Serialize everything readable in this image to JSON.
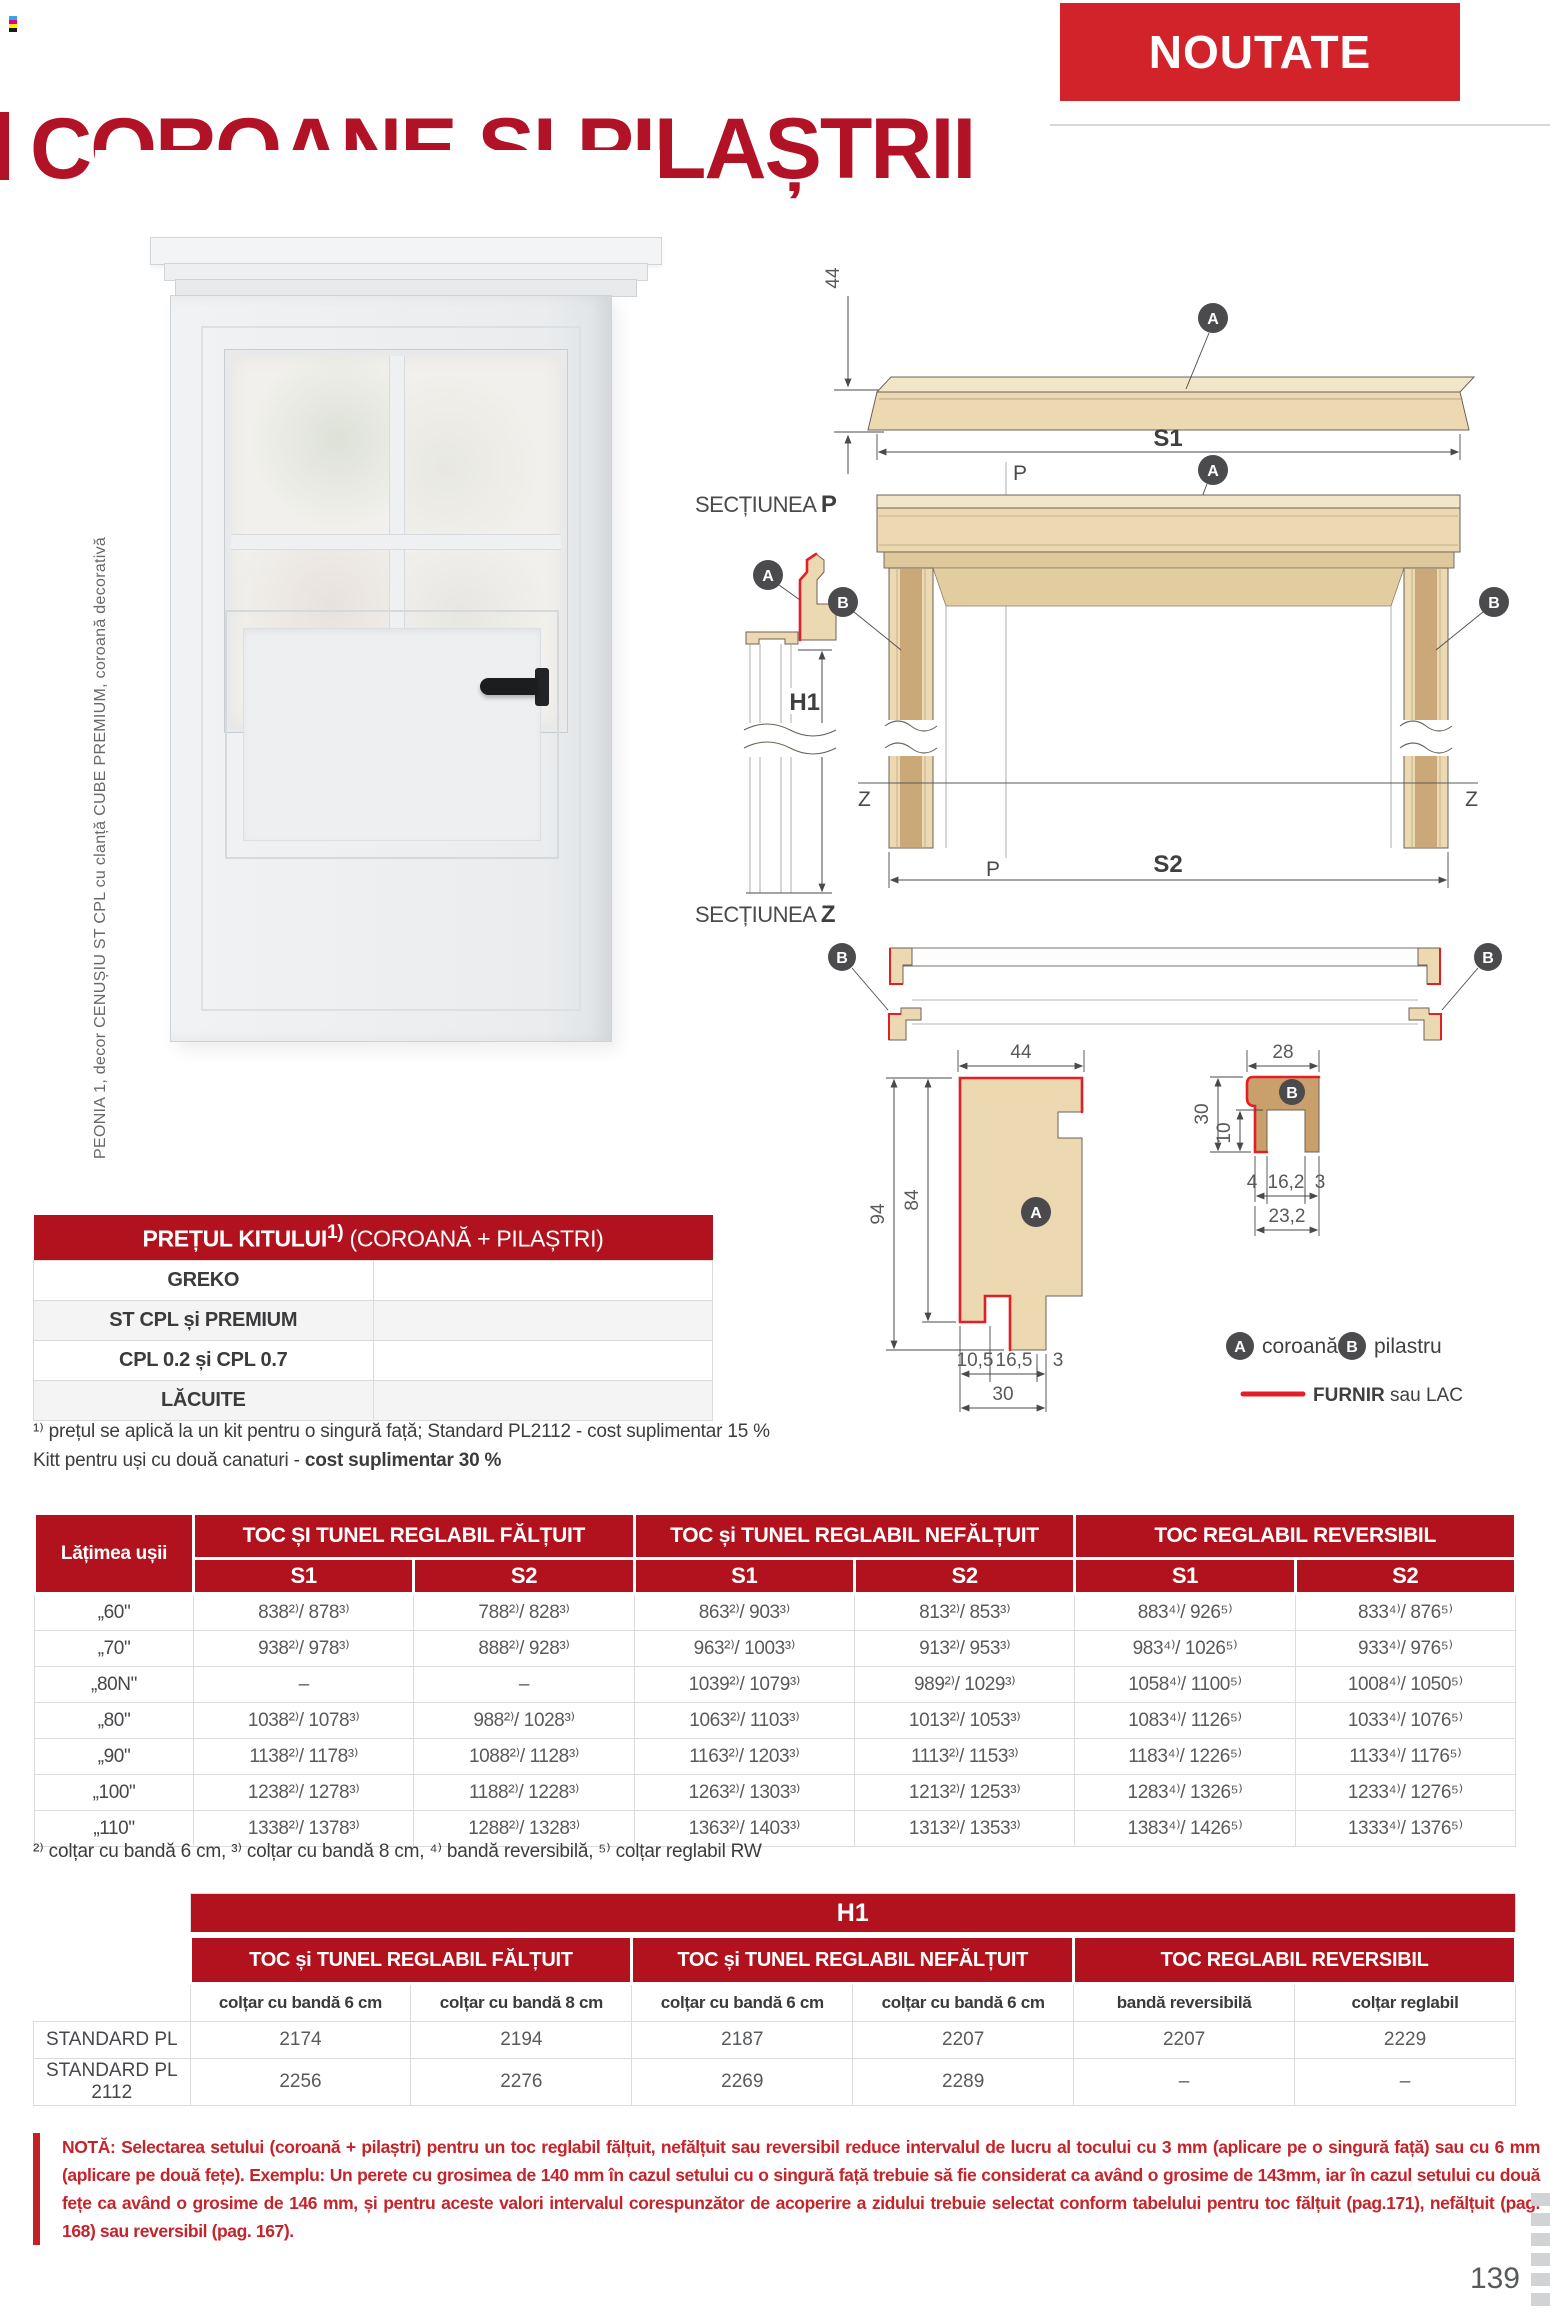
{
  "page": {
    "number": "139"
  },
  "header": {
    "badge": "NOUTATE",
    "title": "COROANE ȘI PILAȘTRII"
  },
  "door": {
    "caption": "PEONIA 1, decor CENUȘIU ST CPL cu clanță CUBE PREMIUM, coroană decorativă"
  },
  "diagram": {
    "section_label": "SECȚIUNEA ",
    "p_letter": "P",
    "z_letter": "Z",
    "s1": "S1",
    "s2": "S2",
    "h1": "H1",
    "p_mark": "P",
    "z_mark": "Z",
    "a": "A",
    "b": "B",
    "dims": {
      "v44": "44",
      "v28": "28",
      "v94": "94",
      "v84": "84",
      "v105": "10,5",
      "v165": "16,5",
      "v3": "3",
      "v30": "30",
      "v10": "10",
      "v4": "4",
      "v162": "16,2",
      "v232": "23,2"
    },
    "legend": {
      "a_label": "coroană",
      "b_label": "pilastru",
      "furnir_bold": "FURNIR",
      "furnir_rest": " sau LAC"
    }
  },
  "price_table": {
    "title_main": "PREȚUL KITULUI",
    "title_sup": "1)",
    "title_rest": " (COROANĂ + PILAȘTRI)",
    "rows": [
      {
        "label": "GREKO",
        "value": ""
      },
      {
        "label": "ST CPL și PREMIUM",
        "value": ""
      },
      {
        "label": "CPL 0.2 și CPL 0.7",
        "value": ""
      },
      {
        "label": "LĂCUITE",
        "value": ""
      }
    ],
    "footnote1": "¹⁾ prețul se aplică la un kit pentru o singură față; Standard PL2112 - cost suplimentar 15 %",
    "footnote2_regular": "Kitt pentru uși cu două canaturi - ",
    "footnote2_bold": "cost suplimentar 30 %"
  },
  "main_table": {
    "corner": "Lățimea ușii",
    "groups": [
      "TOC ȘI TUNEL REGLABIL FĂLȚUIT",
      "TOC și TUNEL REGLABIL NEFĂLȚUIT",
      "TOC REGLABIL REVERSIBIL"
    ],
    "subheaders": [
      "S1",
      "S2",
      "S1",
      "S2",
      "S1",
      "S2"
    ],
    "rows": [
      {
        "label": "„60\"",
        "cells": [
          "838²⁾/ 878³⁾",
          "788²⁾/ 828³⁾",
          "863²⁾/ 903³⁾",
          "813²⁾/ 853³⁾",
          "883⁴⁾/ 926⁵⁾",
          "833⁴⁾/ 876⁵⁾"
        ]
      },
      {
        "label": "„70\"",
        "cells": [
          "938²⁾/ 978³⁾",
          "888²⁾/ 928³⁾",
          "963²⁾/ 1003³⁾",
          "913²⁾/ 953³⁾",
          "983⁴⁾/ 1026⁵⁾",
          "933⁴⁾/ 976⁵⁾"
        ]
      },
      {
        "label": "„80N\"",
        "cells": [
          "–",
          "–",
          "1039²⁾/ 1079³⁾",
          "989²⁾/ 1029³⁾",
          "1058⁴⁾/ 1100⁵⁾",
          "1008⁴⁾/ 1050⁵⁾"
        ]
      },
      {
        "label": "„80\"",
        "cells": [
          "1038²⁾/ 1078³⁾",
          "988²⁾/ 1028³⁾",
          "1063²⁾/ 1103³⁾",
          "1013²⁾/ 1053³⁾",
          "1083⁴⁾/ 1126⁵⁾",
          "1033⁴⁾/ 1076⁵⁾"
        ]
      },
      {
        "label": "„90\"",
        "cells": [
          "1138²⁾/ 1178³⁾",
          "1088²⁾/ 1128³⁾",
          "1163²⁾/ 1203³⁾",
          "1113²⁾/ 1153³⁾",
          "1183⁴⁾/ 1226⁵⁾",
          "1133⁴⁾/ 1176⁵⁾"
        ]
      },
      {
        "label": "„100\"",
        "cells": [
          "1238²⁾/ 1278³⁾",
          "1188²⁾/ 1228³⁾",
          "1263²⁾/ 1303³⁾",
          "1213²⁾/ 1253³⁾",
          "1283⁴⁾/ 1326⁵⁾",
          "1233⁴⁾/ 1276⁵⁾"
        ]
      },
      {
        "label": "„110\"",
        "cells": [
          "1338²⁾/ 1378³⁾",
          "1288²⁾/ 1328³⁾",
          "1363²⁾/ 1403³⁾",
          "1313²⁾/ 1353³⁾",
          "1383⁴⁾/ 1426⁵⁾",
          "1333⁴⁾/ 1376⁵⁾"
        ]
      }
    ],
    "footnote": "²⁾ colțar cu bandă 6 cm, ³⁾ colțar cu bandă 8 cm, ⁴⁾ bandă reversibilă, ⁵⁾ colțar reglabil RW"
  },
  "h1_table": {
    "title": "H1",
    "groups": [
      "TOC și TUNEL REGLABIL FĂLȚUIT",
      "TOC și TUNEL REGLABIL NEFĂLȚUIT",
      "TOC REGLABIL REVERSIBIL"
    ],
    "columns": [
      "colțar cu bandă 6 cm",
      "colțar cu bandă 8 cm",
      "colțar cu bandă 6 cm",
      "colțar cu bandă 6 cm",
      "bandă reversibilă",
      "colțar reglabil"
    ],
    "rows": [
      {
        "label": "STANDARD PL",
        "cells": [
          "2174",
          "2194",
          "2187",
          "2207",
          "2207",
          "2229"
        ]
      },
      {
        "label": "STANDARD PL 2112",
        "cells": [
          "2256",
          "2276",
          "2269",
          "2289",
          "–",
          "–"
        ]
      }
    ]
  },
  "note": {
    "prefix": "NOTĂ:",
    "text": " Selectarea setului (coroană + pilaștri) pentru un toc reglabil fălțuit, nefălțuit sau reversibil reduce intervalul de lucru al tocului cu 3 mm (aplicare pe o singură față) sau cu 6 mm (aplicare pe două fețe). Exemplu: Un perete cu grosimea de 140 mm în cazul setului cu o singură față trebuie să fie considerat ca având o grosime de 143mm, iar în cazul setului cu două fețe ca având o grosime de 146 mm, și pentru aceste valori intervalul corespunzător de acoperire a zidului trebuie selectat conform tabelului pentru toc fălțuit (pag.171), nefălțuit (pag. 168) sau reversibil (pag. 167)."
  },
  "colors": {
    "table_red": "#b2121d",
    "badge_red": "#d2232a",
    "title_red": "#b11226",
    "note_red": "#c5242b",
    "furnir_red": "#e31f26",
    "wood_light": "#ecd9b2",
    "wood_dark": "#c9a06b"
  }
}
